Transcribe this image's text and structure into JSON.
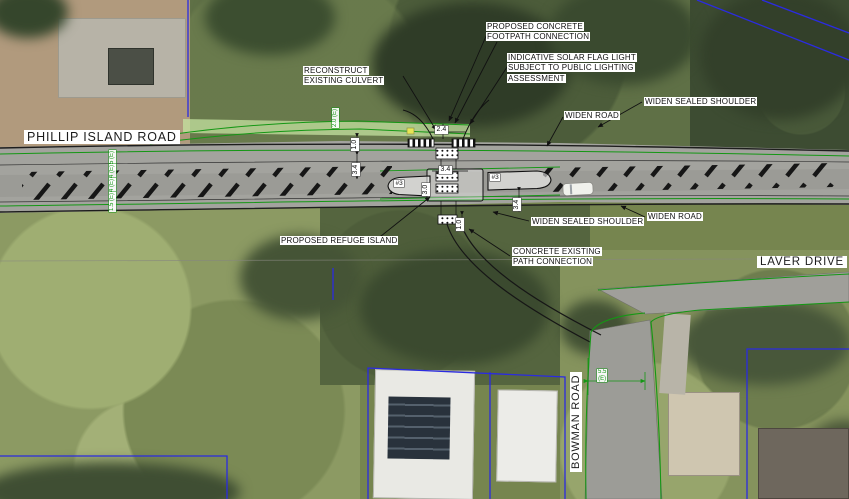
{
  "roads": {
    "phillip_island_road": "PHILLIP ISLAND ROAD",
    "laver_drive": "LAVER DRIVE",
    "bowman_road": "BOWMAN ROAD"
  },
  "callouts": {
    "footpath_connection": "PROPOSED CONCRETE FOOTPATH CONNECTION",
    "solar_light": "INDICATIVE SOLAR FLAG LIGHT SUBJECT TO PUBLIC LIGHTING ASSESSMENT",
    "culvert": "RECONSTRUCT EXISTING CULVERT",
    "widen_road_top": "WIDEN ROAD",
    "widen_shoulder_top": "WIDEN SEALED SHOULDER",
    "refuge_island": "PROPOSED REFUGE ISLAND",
    "widen_shoulder_bottom": "WIDEN SEALED SHOULDER",
    "widen_road_bottom": "WIDEN ROAD",
    "path_connection": "CONCRETE EXISTING PATH CONNECTION"
  },
  "dimensions": {
    "crossing_width": "2.4",
    "verge_top": "1.0",
    "lane_left": "3.4",
    "island_length": "3.4",
    "island_width": "3.0",
    "lane_right": "3.4",
    "verge_bottom": "1.0",
    "arrow_marking_left": "#3",
    "arrow_marking_right": "#3",
    "existing_lanes": [
      "1.5 (E)",
      "3.4 (E)",
      "3.4 (E)",
      "1.5 (E)"
    ],
    "existing_path": "2.0 (E)",
    "bowman_width_value": "5.5",
    "bowman_width_suffix": "(E)"
  },
  "colors": {
    "design_green": "#149714",
    "cadastral_blue": "#2b2be0",
    "road_grey": "#a3a39e",
    "label_text": "#111111",
    "label_background": "#ffffff"
  }
}
